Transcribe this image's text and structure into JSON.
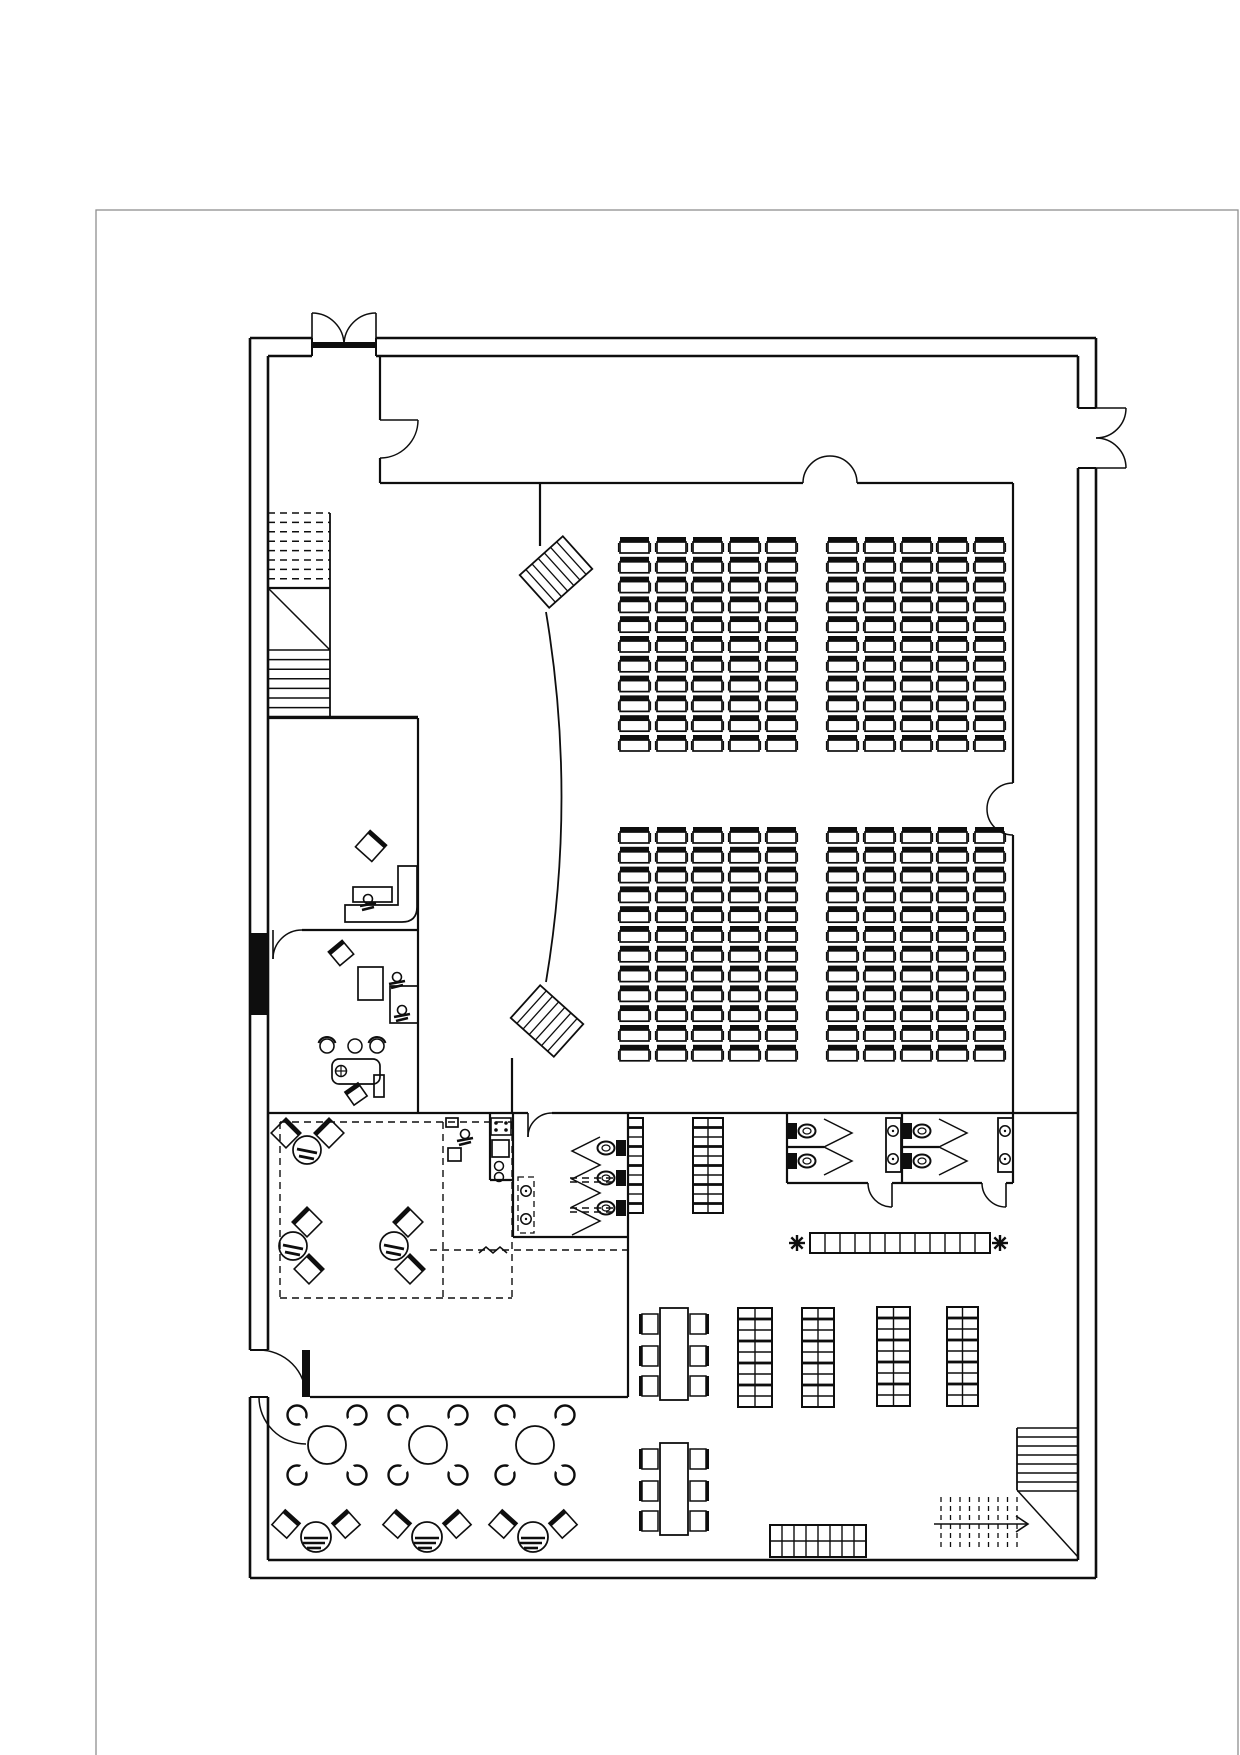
{
  "meta": {
    "title": "auditorium-floor-plan",
    "canvas_w": 1240,
    "canvas_h": 1755
  },
  "colors": {
    "bg": "#ffffff",
    "line": "#0e0e0e",
    "border": "#8f8f8f",
    "fill": "#0e0e0e"
  },
  "page_border": {
    "x": 96,
    "y": 210,
    "w": 1142,
    "h": 1560
  },
  "walls": {
    "outer": [
      [
        250,
        338,
        312,
        338
      ],
      [
        376,
        338,
        1096,
        338
      ],
      [
        1096,
        338,
        1096,
        408
      ],
      [
        1096,
        468,
        1096,
        1578
      ],
      [
        250,
        1578,
        1096,
        1578
      ],
      [
        250,
        338,
        250,
        1350
      ],
      [
        250,
        1397,
        250,
        1578
      ],
      [
        268,
        356,
        312,
        356
      ],
      [
        376,
        356,
        1078,
        356
      ],
      [
        1078,
        356,
        1078,
        408
      ],
      [
        1078,
        468,
        1078,
        1560
      ],
      [
        268,
        1560,
        1078,
        1560
      ],
      [
        268,
        356,
        268,
        1350
      ],
      [
        268,
        1397,
        268,
        1560
      ]
    ],
    "jambs": [
      [
        312,
        338,
        312,
        356
      ],
      [
        376,
        338,
        376,
        356
      ],
      [
        1078,
        408,
        1096,
        408
      ],
      [
        1078,
        468,
        1096,
        468
      ],
      [
        250,
        1350,
        268,
        1350
      ],
      [
        250,
        1397,
        268,
        1397
      ]
    ],
    "inner": [
      [
        380,
        356,
        380,
        420
      ],
      [
        380,
        458,
        380,
        483
      ],
      [
        380,
        483,
        803,
        483
      ],
      [
        857,
        483,
        1013,
        483
      ],
      [
        1013,
        483,
        1013,
        783
      ],
      [
        1013,
        835,
        1013,
        1183
      ],
      [
        540,
        483,
        540,
        546
      ],
      [
        512,
        1058,
        512,
        1113
      ],
      [
        268,
        1113,
        528,
        1113
      ],
      [
        552,
        1113,
        1078,
        1113
      ],
      [
        418,
        718,
        418,
        1113
      ],
      [
        268,
        718,
        418,
        718
      ],
      [
        302,
        930,
        418,
        930
      ],
      [
        513,
        1113,
        513,
        1237
      ],
      [
        513,
        1237,
        628,
        1237
      ],
      [
        628,
        1113,
        628,
        1397
      ],
      [
        310,
        1397,
        628,
        1397
      ],
      [
        787,
        1113,
        787,
        1183
      ],
      [
        787,
        1183,
        868,
        1183
      ],
      [
        892,
        1183,
        982,
        1183
      ],
      [
        1006,
        1183,
        1013,
        1183
      ],
      [
        902,
        1113,
        902,
        1183
      ],
      [
        787,
        1147,
        824,
        1147
      ],
      [
        902,
        1147,
        939,
        1147
      ],
      [
        490,
        1113,
        490,
        1180
      ],
      [
        490,
        1180,
        513,
        1180
      ]
    ],
    "fills": [
      [
        250,
        933,
        18,
        82
      ]
    ]
  },
  "doors": {
    "arcs": [
      "M312,313 A32,32 0 0 1 344,345",
      "M376,313 A32,32 0 0 0 344,345",
      "M1126,408 A30,30 0 0 1 1096,438",
      "M1126,468 A30,30 0 0 0 1096,438",
      "M418,420 A38,38 0 0 1 380,458",
      "M803,483 A27,27 0 0 1 830,456",
      "M857,483 A27,27 0 0 0 830,456",
      "M1013,783 A26,26 0 0 0 987,809",
      "M1013,835 A26,26 0 0 1 987,809",
      "M306,1397 A47,47 0 0 0 259,1350",
      "M259,1397 A47,47 0 0 0 306,1444",
      "M273,959 A29,29 0 0 1 302,930",
      "M892,1207 A24,24 0 0 1 868,1183",
      "M1006,1207 A24,24 0 0 1 982,1183",
      "M528,1137 A24,24 0 0 1 552,1113"
    ],
    "leaves": [
      [
        312,
        313,
        312,
        345
      ],
      [
        376,
        313,
        376,
        345
      ],
      [
        1096,
        408,
        1126,
        408
      ],
      [
        1096,
        468,
        1126,
        468
      ],
      [
        380,
        420,
        418,
        420
      ],
      [
        273,
        930,
        273,
        959
      ],
      [
        892,
        1183,
        892,
        1207
      ],
      [
        1006,
        1183,
        1006,
        1207
      ],
      [
        528,
        1113,
        528,
        1137
      ]
    ],
    "sills": [
      [
        312,
        342,
        64,
        6
      ],
      [
        302,
        1350,
        8,
        47
      ]
    ]
  },
  "stage": {
    "curve": "M546,612 Q577,797 546,982",
    "hatches": [
      {
        "cx": 556,
        "cy": 572,
        "w": 58,
        "h": 44,
        "rot": -42,
        "lines": 6
      },
      {
        "cx": 547,
        "cy": 1021,
        "w": 58,
        "h": 44,
        "rot": 42,
        "lines": 6
      }
    ]
  },
  "seating": {
    "chair_w": 29,
    "chair_h": 16,
    "back_h": 5,
    "columns_x": [
      620,
      657,
      693,
      730,
      767,
      828,
      865,
      902,
      938,
      975
    ],
    "blocks": [
      {
        "name": "seat-block-top",
        "y0": 537,
        "rows": 11,
        "pitch": 19.8
      },
      {
        "name": "seat-block-bottom",
        "y0": 827,
        "rows": 12,
        "pitch": 19.8
      }
    ]
  },
  "stairs": {
    "nw": {
      "x": 268,
      "w": 62,
      "dash_y0": 513,
      "dash_rows": 8,
      "dash_pitch": 9.4,
      "land_y0": 588,
      "land_y1": 650,
      "solid_y0": 650,
      "solid_rows": 7,
      "solid_pitch": 9.6,
      "y1": 717
    },
    "se": {
      "solid_x": 1017,
      "solid_w": 61,
      "solid_y0": 1428,
      "solid_rows": 8,
      "solid_pitch": 9,
      "diag": [
        1017,
        1490,
        1078,
        1557
      ],
      "dash_x0": 941,
      "dash_cols": 9,
      "dash_pitch": 9.5,
      "dash_y0": 1497,
      "dash_y1": 1550,
      "arrow": [
        934,
        1524,
        1028,
        1524
      ]
    }
  },
  "grids": [
    {
      "name": "storage-rack",
      "x": 628,
      "y": 1118,
      "cols": 1,
      "rows": 10,
      "cw": 15,
      "ch": 9.5,
      "stocked": true
    },
    {
      "name": "storage-rack",
      "x": 693,
      "y": 1118,
      "cols": 2,
      "rows": 10,
      "cw": 15,
      "ch": 9.5,
      "stocked": true
    },
    {
      "name": "storage-rack",
      "x": 738,
      "y": 1308,
      "cols": 2,
      "rows": 9,
      "cw": 17,
      "ch": 11,
      "stocked": true
    },
    {
      "name": "storage-rack",
      "x": 802,
      "y": 1308,
      "cols": 2,
      "rows": 9,
      "cw": 16,
      "ch": 11,
      "stocked": true
    },
    {
      "name": "storage-rack",
      "x": 877,
      "y": 1307,
      "cols": 2,
      "rows": 9,
      "cw": 16.5,
      "ch": 11,
      "stocked": true
    },
    {
      "name": "storage-rack",
      "x": 947,
      "y": 1307,
      "cols": 2,
      "rows": 9,
      "cw": 15.5,
      "ch": 11,
      "stocked": true
    },
    {
      "name": "wash-counter",
      "x": 810,
      "y": 1233,
      "cols": 12,
      "rows": 1,
      "cw": 15,
      "ch": 20,
      "stocked": false
    },
    {
      "name": "display-counter",
      "x": 770,
      "y": 1525,
      "cols": 8,
      "rows": 2,
      "cw": 12,
      "ch": 16,
      "stocked": false
    }
  ],
  "toilets": [
    {
      "cx": 606,
      "cy": 1148,
      "dir": "left"
    },
    {
      "cx": 606,
      "cy": 1178,
      "dir": "left"
    },
    {
      "cx": 606,
      "cy": 1208,
      "dir": "left"
    },
    {
      "cx": 807,
      "cy": 1131,
      "dir": "right"
    },
    {
      "cx": 807,
      "cy": 1161,
      "dir": "right"
    },
    {
      "cx": 922,
      "cy": 1131,
      "dir": "right"
    },
    {
      "cx": 922,
      "cy": 1161,
      "dir": "right"
    }
  ],
  "sink_columns": [
    [
      886,
      1118,
      15,
      54
    ],
    [
      998,
      1118,
      15,
      54
    ]
  ],
  "basin_box": [
    518,
    1177,
    16,
    56
  ],
  "sinks": [
    [
      526,
      1191
    ],
    [
      526,
      1219
    ],
    [
      893,
      1131
    ],
    [
      893,
      1159
    ],
    [
      1005,
      1131
    ],
    [
      1005,
      1159
    ]
  ],
  "zigzags": [
    [
      [
        600,
        1137
      ],
      [
        572,
        1151
      ],
      [
        600,
        1165
      ],
      [
        572,
        1179
      ],
      [
        600,
        1193
      ],
      [
        572,
        1207
      ],
      [
        600,
        1221
      ],
      [
        572,
        1235
      ]
    ],
    [
      [
        824,
        1119
      ],
      [
        852,
        1133
      ],
      [
        824,
        1147
      ],
      [
        852,
        1161
      ],
      [
        824,
        1175
      ]
    ],
    [
      [
        939,
        1119
      ],
      [
        967,
        1133
      ],
      [
        939,
        1147
      ],
      [
        967,
        1161
      ],
      [
        939,
        1175
      ]
    ],
    [
      [
        479,
        1253
      ],
      [
        486,
        1247
      ],
      [
        493,
        1253
      ],
      [
        500,
        1247
      ],
      [
        507,
        1253
      ]
    ]
  ],
  "dashed": [
    [
      280,
      1122,
      512,
      1122
    ],
    [
      280,
      1122,
      280,
      1298
    ],
    [
      280,
      1298,
      512,
      1298
    ],
    [
      512,
      1122,
      512,
      1298
    ],
    [
      443,
      1122,
      443,
      1298
    ],
    [
      430,
      1250,
      628,
      1250
    ],
    [
      570,
      1178,
      627,
      1178
    ],
    [
      570,
      1182,
      627,
      1182
    ],
    [
      570,
      1208,
      627,
      1208
    ],
    [
      570,
      1212,
      627,
      1212
    ]
  ],
  "round_tables": {
    "r": 19,
    "chair_r": 9.5,
    "chair_off": 30,
    "centers": [
      [
        327,
        1445
      ],
      [
        428,
        1445
      ],
      [
        535,
        1445
      ]
    ]
  },
  "sofa_units": {
    "r": 15,
    "chair": 20,
    "centers": [
      [
        316,
        1537
      ],
      [
        427,
        1537
      ],
      [
        533,
        1537
      ]
    ]
  },
  "long_tables": {
    "w": 28,
    "h": 92,
    "chair_w": 16,
    "chair_h": 20,
    "rows_rel": [
      6,
      38,
      68
    ],
    "x": 660,
    "ys": [
      1308,
      1443
    ]
  },
  "salon_units": [
    {
      "circle": [
        307,
        1150
      ],
      "chairs": [
        [
          286,
          1133,
          45
        ],
        [
          329,
          1133,
          -45
        ]
      ]
    },
    {
      "circle": [
        293,
        1246
      ],
      "chairs": [
        [
          307,
          1222,
          -45
        ],
        [
          309,
          1269,
          45
        ]
      ]
    },
    {
      "circle": [
        394,
        1246
      ],
      "chairs": [
        [
          408,
          1222,
          -45
        ],
        [
          410,
          1269,
          45
        ]
      ]
    }
  ],
  "salon_chair_size": 21,
  "office": {
    "rects": [
      [
        353,
        887,
        39,
        15
      ],
      [
        358,
        967,
        25,
        33
      ],
      [
        390,
        986,
        28,
        37
      ],
      [
        374,
        1075,
        10,
        22
      ],
      [
        446,
        1118,
        12,
        9
      ],
      [
        448,
        1148,
        13,
        13
      ],
      [
        492,
        1140,
        17,
        17
      ]
    ],
    "round_rects": [
      [
        332,
        1059,
        48,
        25
      ]
    ],
    "sofa_path": "M398,866 L417,866 L417,907 Q417,922 402,922 L345,922 L345,905 L398,905 Z",
    "tilted_chairs": [
      [
        371,
        846,
        42,
        22
      ],
      [
        341,
        953,
        -40,
        18
      ],
      [
        356,
        1094,
        -35,
        16
      ]
    ],
    "stove": {
      "x": 491,
      "y": 1118,
      "w": 20,
      "h": 17
    },
    "small_circles": [
      [
        499,
        1166,
        4.5
      ],
      [
        499,
        1177,
        4.5
      ],
      [
        355,
        1046,
        7
      ]
    ],
    "arc_chairs": [
      [
        327,
        1046
      ],
      [
        377,
        1046
      ]
    ],
    "plant_table": [
      341,
      1071
    ],
    "persons": [
      [
        368,
        899
      ],
      [
        397,
        977
      ],
      [
        402,
        1010
      ],
      [
        465,
        1134
      ]
    ]
  },
  "plants": [
    [
      797,
      1243
    ],
    [
      1000,
      1243
    ]
  ]
}
